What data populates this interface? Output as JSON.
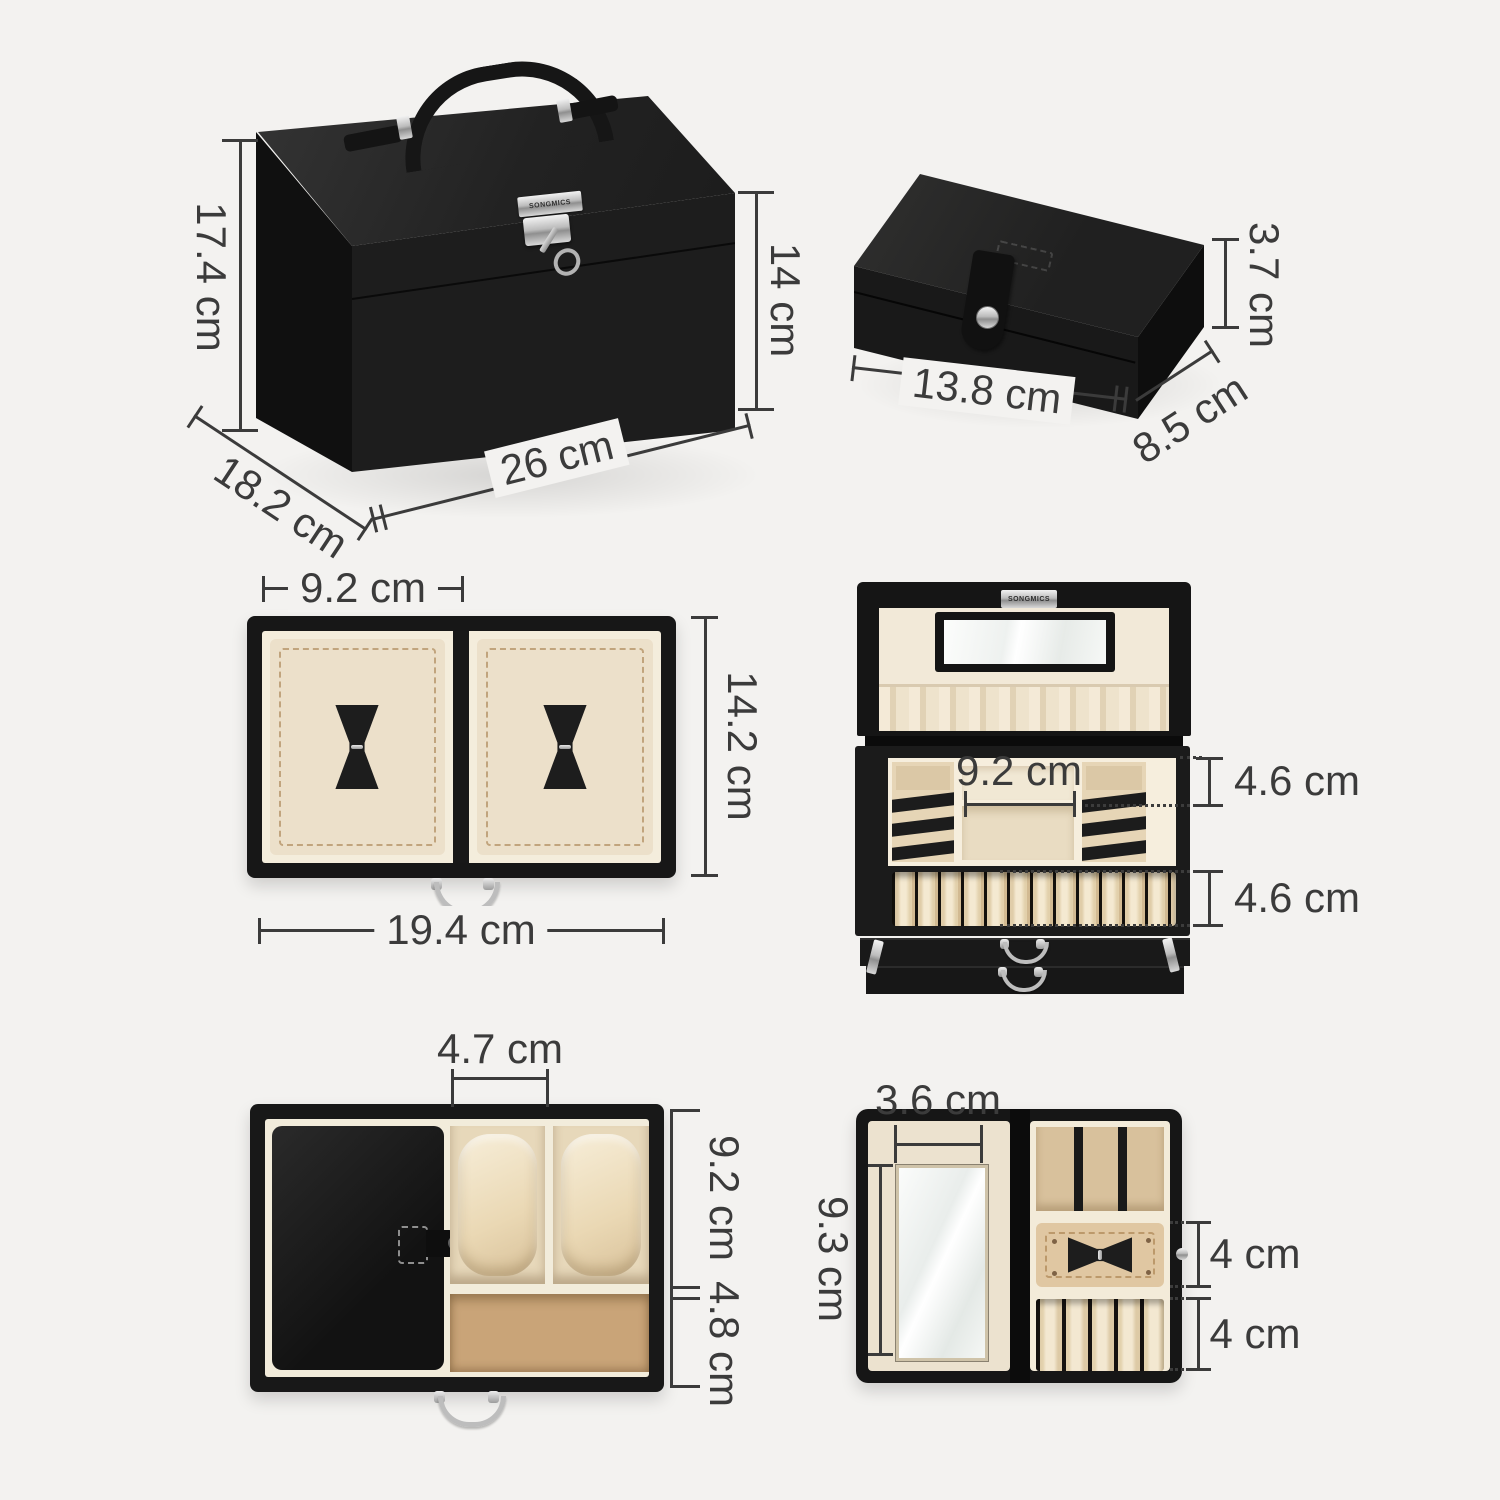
{
  "canvas": {
    "width": 1500,
    "height": 1500,
    "background": "#f3f2f0"
  },
  "brand": "SONGMICS",
  "unit": "cm",
  "palette": {
    "box_black": "#1b1b1b",
    "lining_cream": "#f0e6d2",
    "suede_tan": "#c9a478",
    "metal_silver": "#c6c6c6",
    "dimension_ink": "#3b3b3b"
  },
  "views": {
    "closed_box": {
      "dims": {
        "total_height": "17.4 cm",
        "body_height": "14 cm",
        "depth": "18.2 cm",
        "width": "26 cm"
      }
    },
    "travel_case": {
      "dims": {
        "height": "3.7 cm",
        "width": "13.8 cm",
        "depth": "8.5 cm"
      }
    },
    "pad_drawer": {
      "dims": {
        "pad_width": "9.2 cm",
        "inner_depth": "14.2 cm",
        "inner_width": "19.4 cm"
      }
    },
    "open_box": {
      "dims": {
        "middle_compartment_width": "9.2 cm",
        "tray_depth": "4.6 cm",
        "ring_row_depth": "4.6 cm"
      }
    },
    "watch_drawer": {
      "dims": {
        "watch_slot_width": "4.7 cm",
        "upper_depth": "9.2 cm",
        "lower_depth": "4.8 cm"
      }
    },
    "open_case": {
      "dims": {
        "mirror_width": "3.6 cm",
        "mirror_height": "9.3 cm",
        "pad_depth": "4 cm",
        "ring_row_depth": "4 cm"
      }
    }
  }
}
